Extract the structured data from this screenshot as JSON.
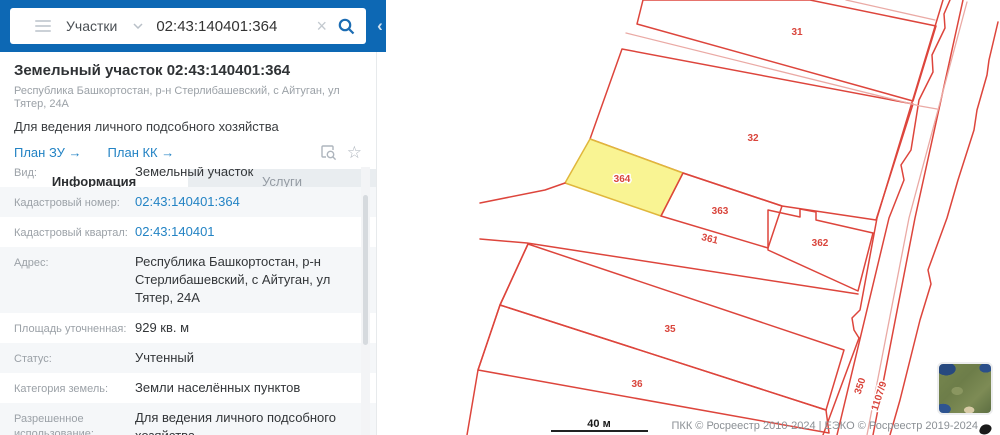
{
  "topbar": {
    "category": "Участки",
    "query": "02:43:140401:364",
    "clear_glyph": "×",
    "collapse_glyph": "‹"
  },
  "panel": {
    "title": "Земельный участок 02:43:140401:364",
    "subtitle": "Республика Башкортостан, р-н Стерлибашевский, с Айтуган, ул Тятер, 24А",
    "description": "Для ведения личного подсобного хозяйства",
    "links": {
      "plan_zu": "План ЗУ →",
      "plan_kk": "План КК →"
    },
    "star_glyph": "☆",
    "tabs": {
      "info": "Информация",
      "services": "Услуги"
    },
    "rows": [
      {
        "label": "Вид:",
        "value": "Земельный участок"
      },
      {
        "label": "Кадастровый номер:",
        "value": "02:43:140401:364"
      },
      {
        "label": "Кадастровый квартал:",
        "value": "02:43:140401"
      },
      {
        "label": "Адрес:",
        "value": "Республика Башкортостан, р-н Стерлибашевский, с Айтуган, ул Тятер, 24А"
      },
      {
        "label": "Площадь уточненная:",
        "value": "929 кв. м"
      },
      {
        "label": "Статус:",
        "value": "Учтенный"
      },
      {
        "label": "Категория земель:",
        "value": "Земли населённых пунктов"
      },
      {
        "label": "Разрешенное использование:",
        "value": "Для ведения личного подсобного хозяйства"
      }
    ]
  },
  "map": {
    "highlighted_parcel": "364",
    "labels": {
      "p31": "31",
      "p32": "32",
      "p364": "364",
      "p363": "363",
      "p361": "361",
      "p362": "362",
      "p35": "35",
      "p36": "36",
      "p350": "350",
      "p1107": "1107/9"
    },
    "scale": "40 м",
    "attribution": "ПКК © Росреестр 2010-2024 | ЕЭКО © Росреестр 2019-2024",
    "colors": {
      "parcel_line": "#dd453c",
      "highlight_fill": "#f9f493",
      "highlight_stroke": "#e0b73c",
      "road_center": "#eaaaa5"
    }
  }
}
